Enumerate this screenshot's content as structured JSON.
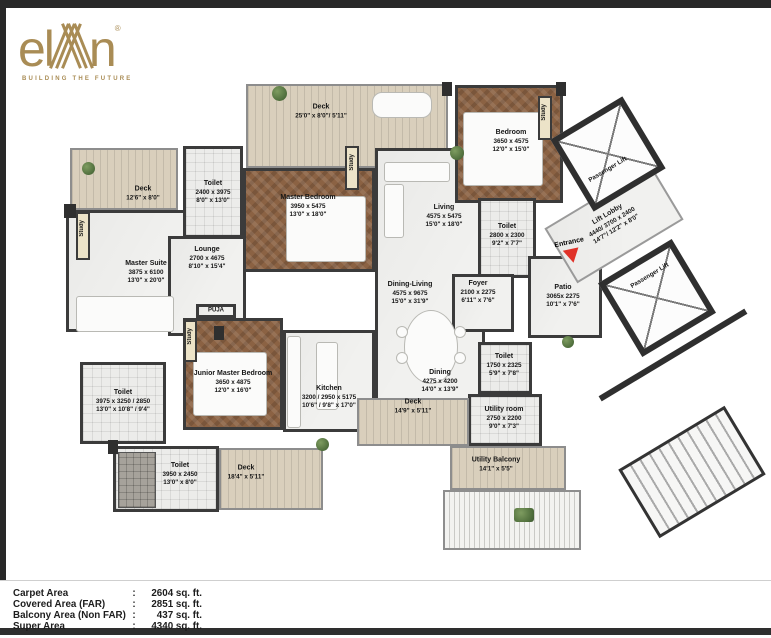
{
  "brand": {
    "logo_text_el": "el",
    "logo_text_n": "n",
    "registered": "®",
    "tagline": "BUILDING THE FUTURE"
  },
  "plan": {
    "rooms": {
      "deck_left": {
        "name": "Deck",
        "imperial": "12'6\" x 8'0\""
      },
      "master_suite": {
        "name": "Master Suite",
        "metric": "3875 x 6100",
        "imperial": "13'0\" x 20'0\""
      },
      "study_suite": {
        "name": "Study"
      },
      "toilet_suite": {
        "name": "Toilet",
        "metric": "3975 x 3250 / 2850",
        "imperial": "13'0\" x 10'8\" / 9'4\""
      },
      "toilet_bottom": {
        "name": "Toilet",
        "metric": "3950 x 2450",
        "imperial": "13'0\" x 8'0\""
      },
      "deck_bottom": {
        "name": "Deck",
        "imperial": "18'4\" x 5'11\""
      },
      "toilet_top": {
        "name": "Toilet",
        "metric": "2400 x 3975",
        "imperial": "8'0\" x 13'0\""
      },
      "deck_top": {
        "name": "Deck",
        "imperial": "25'0\" x 8'0\"/ 5'11\""
      },
      "master_bedroom": {
        "name": "Master Bedroom",
        "metric": "3950 x 5475",
        "imperial": "13'0\" x 18'0\""
      },
      "study_master": {
        "name": "Study"
      },
      "lounge": {
        "name": "Lounge",
        "metric": "2700 x 4675",
        "imperial": "8'10\" x 15'4\""
      },
      "puja": {
        "name": "PUJA"
      },
      "junior_master_bedroom": {
        "name": "Junior Master Bedroom",
        "metric": "3650 x 4875",
        "imperial": "12'0\" x 16'0\""
      },
      "study_junior": {
        "name": "Study"
      },
      "kitchen": {
        "name": "Kitchen",
        "metric": "3200 / 2950 x 5175",
        "imperial": "10'6\" / 9'8\" x 17'0\""
      },
      "living": {
        "name": "Living",
        "metric": "4575 x 5475",
        "imperial": "15'0\" x 18'0\""
      },
      "dining_living": {
        "name": "Dining-Living",
        "metric": "4575 x 9675",
        "imperial": "15'0\" x 31'9\""
      },
      "dining": {
        "name": "Dining",
        "metric": "4275 x 4200",
        "imperial": "14'0\" x 13'9\""
      },
      "deck_mid": {
        "name": "Deck",
        "imperial": "14'9\" x 5'11\""
      },
      "bedroom": {
        "name": "Bedroom",
        "metric": "3650 x 4575",
        "imperial": "12'0\" x 15'0\""
      },
      "study_bedroom": {
        "name": "Study"
      },
      "toilet_mid": {
        "name": "Toilet",
        "metric": "2800 x 2300",
        "imperial": "9'2\" x 7'7\""
      },
      "foyer": {
        "name": "Foyer",
        "metric": "2100 x 2275",
        "imperial": "6'11\" x 7'6\""
      },
      "toilet_right": {
        "name": "Toilet",
        "metric": "1750 x 2325",
        "imperial": "5'9\" x 7'8\""
      },
      "utility_room": {
        "name": "Utility room",
        "metric": "2750 x 2200",
        "imperial": "9'0\" x 7'3\""
      },
      "utility_balcony": {
        "name": "Utility Balcony",
        "imperial": "14'1\" x 5'5\""
      },
      "patio": {
        "name": "Patio",
        "metric": "3065x 2275",
        "imperial": "10'1\" x 7'6\""
      },
      "lift_lobby": {
        "name": "Lift Lobby",
        "metric": "4440/ 3700 x 2400",
        "imperial": "14'7\"/ 12'2\" x 8'0\""
      },
      "passenger_lift_1": {
        "name": "Passenger Lift"
      },
      "passenger_lift_2": {
        "name": "Passenger Lift"
      },
      "entrance": {
        "name": "Entrance"
      }
    }
  },
  "area_table": {
    "rows": [
      {
        "label": "Carpet Area",
        "separator": ":",
        "value": "2604 sq. ft."
      },
      {
        "label": "Covered Area (FAR)",
        "separator": ":",
        "value": "2851 sq. ft."
      },
      {
        "label": "Balcony Area (Non FAR)",
        "separator": ":",
        "value": "437 sq. ft."
      },
      {
        "label": "Super Area",
        "separator": ":",
        "value": "4340 sq. ft."
      }
    ]
  },
  "colors": {
    "brand_gold": "#a98c55",
    "wall": "#3b3b3b",
    "wood_floor": "#8b6243",
    "deck_floor": "#d9cfbc",
    "marble_floor": "#f1f1ef",
    "tile_floor": "#ececea",
    "entrance_marker": "#e03128",
    "plant_green": "#5c7d4a"
  }
}
